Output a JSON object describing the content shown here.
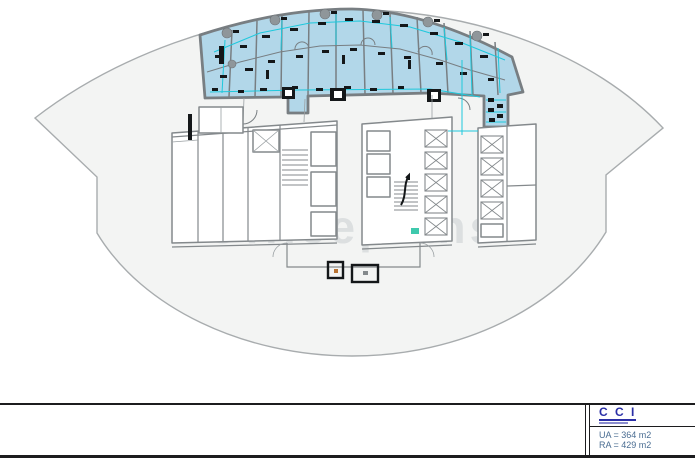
{
  "colors": {
    "page_bg": "#ffffff",
    "lens_fill": "#f3f4f3",
    "lens_outline": "#a8acae",
    "highlight_fill": "#b2d7e9",
    "highlight_wall": "#787e82",
    "dimension_cyan": "#1ec8dc",
    "core_line": "#84898c",
    "glyph_black": "#141719",
    "accent_teal": "#3fc9ad",
    "frame_black": "#1c1c1e",
    "logo_blue": "#2b2fa6",
    "area_text_blue": "#4a6d92",
    "watermark_gray": "#dcdfe0"
  },
  "watermark": {
    "text": "Officeplans"
  },
  "title_block": {
    "company": "C C I",
    "ua_label": "UA = 364 m2",
    "ra_label": "RA = 429 m2"
  }
}
